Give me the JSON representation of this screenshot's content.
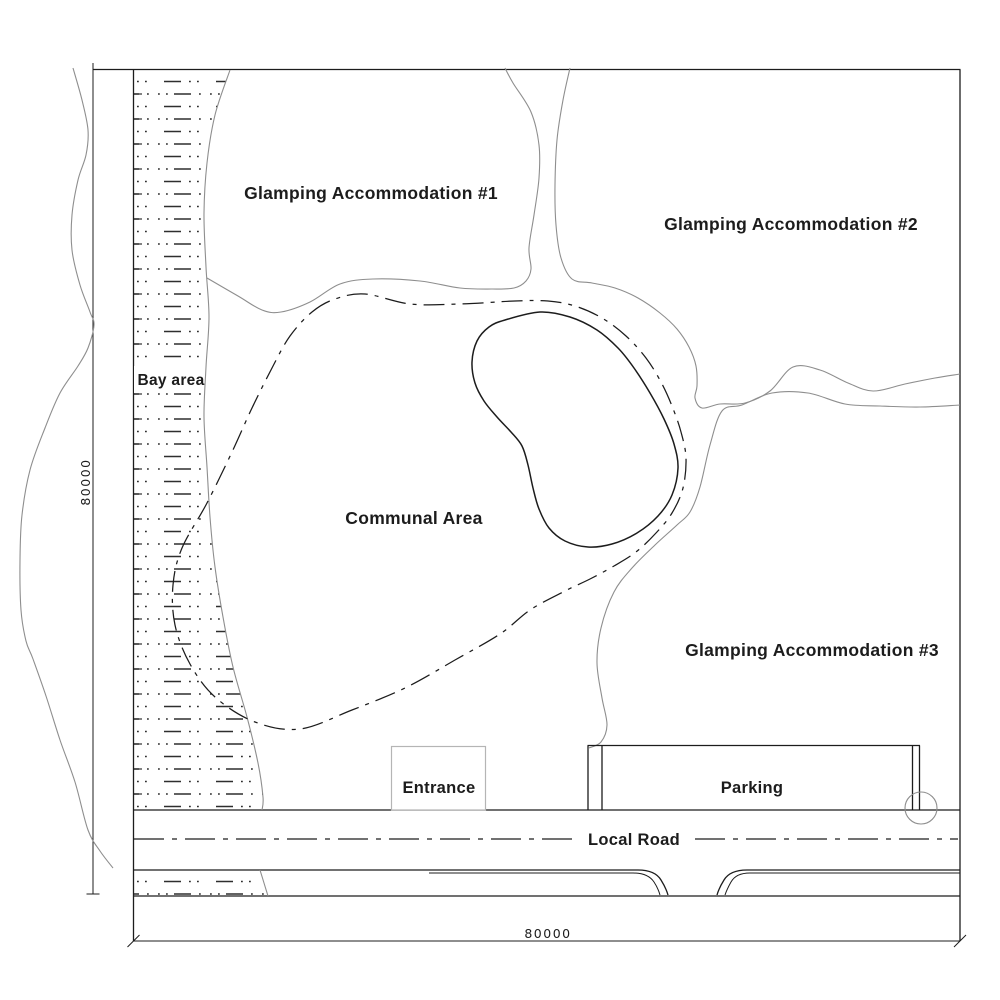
{
  "plan": {
    "areas": {
      "accommodation_1": "Glamping Accommodation #1",
      "accommodation_2": "Glamping Accommodation #2",
      "accommodation_3": "Glamping Accommodation #3",
      "communal": "Communal Area",
      "bay": "Bay area"
    },
    "features": {
      "entrance": "Entrance",
      "parking": "Parking",
      "road": "Local Road"
    },
    "dimensions": {
      "site_height": "80000",
      "site_width": "80000"
    },
    "colors": {
      "line": "#1c1c1c",
      "secondary_line": "#8e8e8e",
      "label": "#1c1c1c",
      "box_border": "#b5b5b5",
      "background": "#ffffff"
    }
  }
}
